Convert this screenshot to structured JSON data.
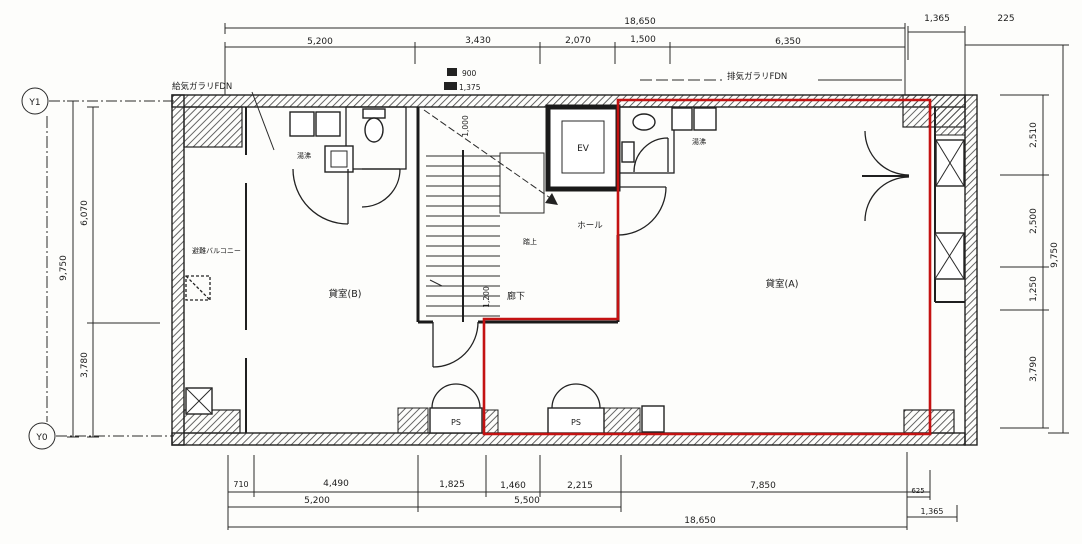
{
  "grid": {
    "y1": "Y1",
    "y0": "Y0"
  },
  "rooms": {
    "a": "貸室(A)",
    "b": "貸室(B)",
    "hall": "ホール",
    "corridor": "廊下",
    "ev": "EV",
    "ps": "PS",
    "landing": "踏上",
    "balcony": "避難バルコニー",
    "kitchenette": "湯沸"
  },
  "notes": {
    "supply_louver": "給気ガラリFDN",
    "exhaust_louver": "排気ガラリFDN"
  },
  "dims": {
    "top": {
      "total": "18,650",
      "s1": "5,200",
      "s2": "3,430",
      "s3": "2,070",
      "s4": "1,500",
      "s5": "6,350",
      "r1": "1,365",
      "r2": "225",
      "k1": "900",
      "k2": "1,375"
    },
    "bottom": {
      "s1": "710",
      "s2": "4,490",
      "s3": "1,825",
      "s4": "1,460",
      "s5": "2,215",
      "s6": "7,850",
      "s7": "625",
      "g1": "5,200",
      "g2": "5,500",
      "total": "18,650",
      "r1": "1,365"
    },
    "left": {
      "total": "9,750",
      "s1": "6,070",
      "s2": "3,780"
    },
    "right": {
      "s1": "2,510",
      "s2": "2,500",
      "s3": "1,250",
      "s4": "3,790",
      "total": "9,750"
    },
    "inner": {
      "stair": "1,000",
      "corridor": "1,200"
    }
  },
  "highlight": {
    "color": "#c41212"
  }
}
